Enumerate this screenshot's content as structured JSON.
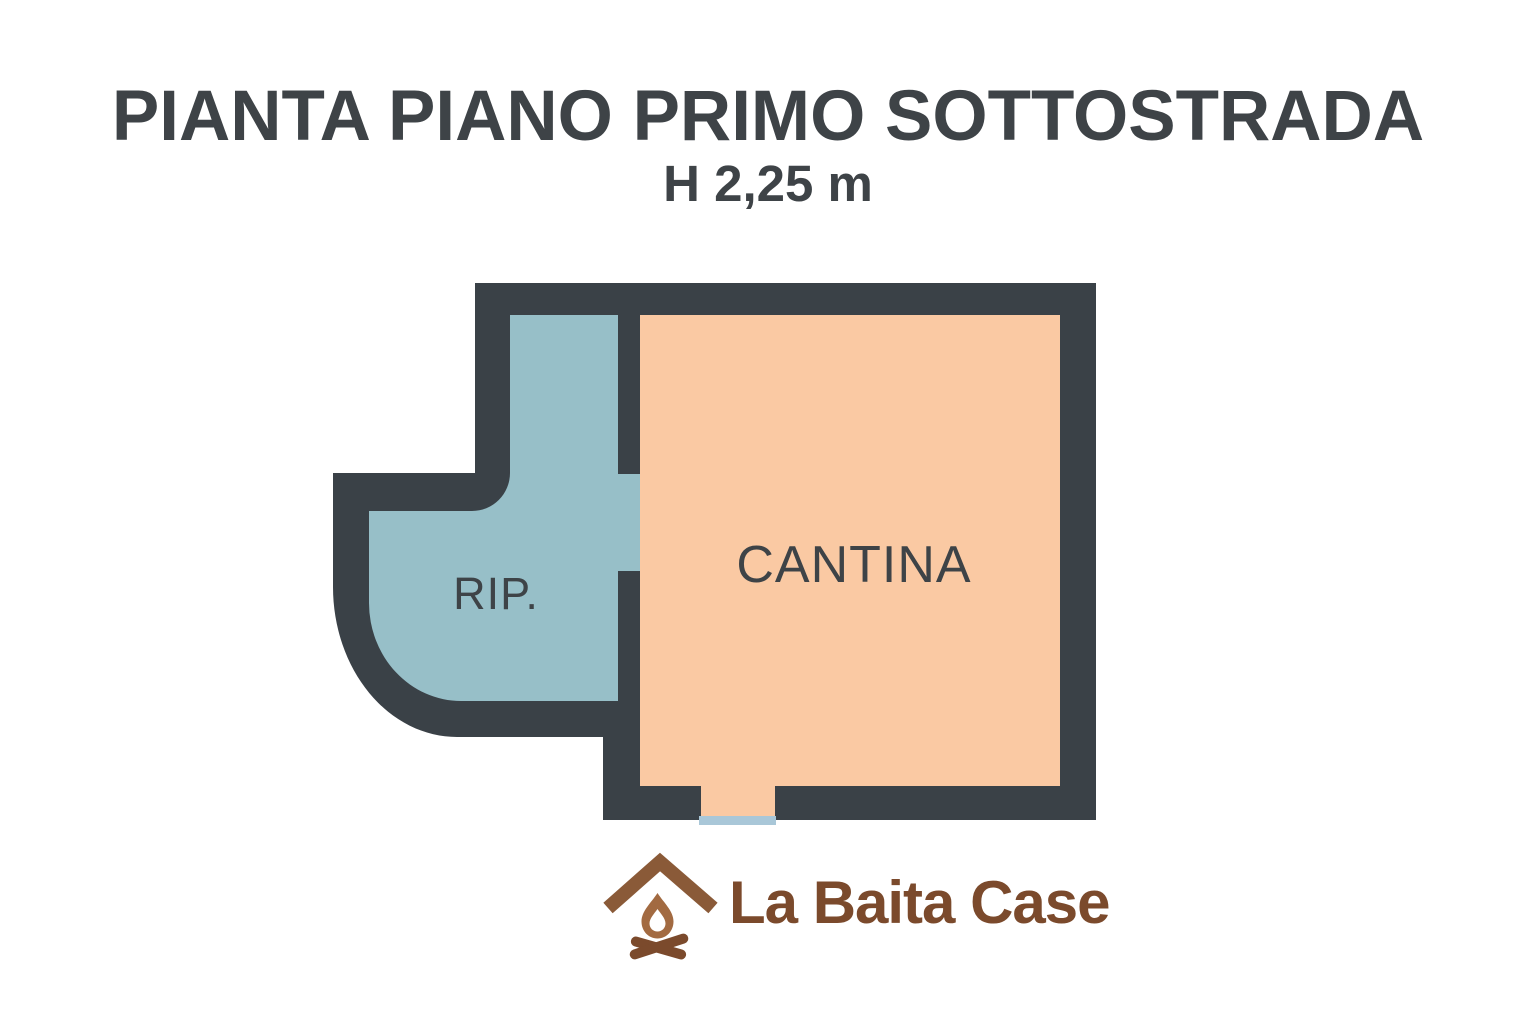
{
  "page": {
    "background": "#ffffff"
  },
  "header": {
    "title": "PIANTA PIANO PRIMO SOTTOSTRADA",
    "subtitle": "H 2,25 m",
    "text_color": "#3e4347"
  },
  "floorplan": {
    "wall_color": "#3a4147",
    "label_color": "#3e4347",
    "rooms": [
      {
        "id": "rip",
        "label": "RIP.",
        "fill": "#97bfc8"
      },
      {
        "id": "cantina",
        "label": "CANTINA",
        "fill": "#fac9a3"
      }
    ],
    "door_threshold_color": "#a9c7d8"
  },
  "logo": {
    "text": "La Baita Case",
    "text_color": "#7b4a2c",
    "icon": "house-campfire-icon",
    "icon_roof_color": "#8a5a38",
    "icon_flame_color": "#a26a41",
    "icon_logs_color": "#7b4a2c"
  }
}
